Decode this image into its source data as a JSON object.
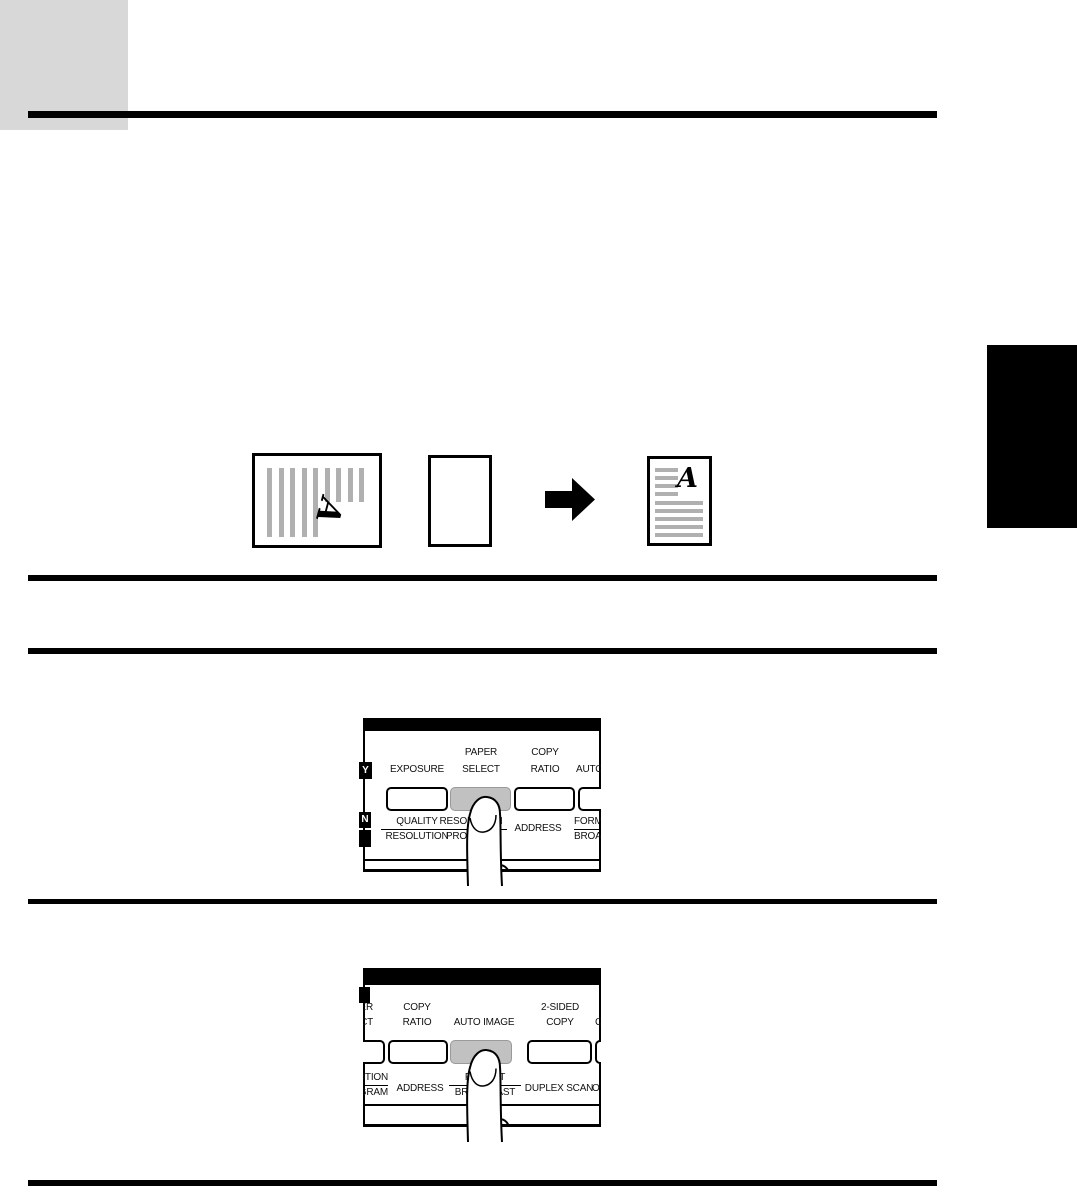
{
  "colors": {
    "page_bg": "#ffffff",
    "corner_block": "#d8d8d8",
    "side_index_tab": "#000000",
    "rules": "#000000",
    "panel_top_bar": "#000000",
    "key_face": "#ffffff",
    "pressed_key": "#c1c1c1",
    "thumbnail_stripes": "#b0b0b0"
  },
  "icons": {
    "arrow": "right-arrow-icon",
    "finger": "pointing-finger-icon"
  },
  "diagram": {
    "original_letter": "A",
    "output_letter": "A"
  },
  "panel1": {
    "side_tab_top": "Y",
    "side_tab_bottom": "N",
    "col1_line2": "EXPOSURE",
    "col2_line1": "PAPER",
    "col2_line2": "SELECT",
    "col3_line1": "COPY",
    "col3_line2": "RATIO",
    "col4_line2": "AUTO IMAGE",
    "bot1_top": "QUALITY",
    "bot1_bottom": "RESOLUTION",
    "bot2_top": "RESOLUTION",
    "bot2_bottom": "PROGRAM",
    "bot3": "ADDRESS",
    "bot4_top": "FORMAT",
    "bot4_bottom": "BROADCAST"
  },
  "panel2": {
    "edge_line1": "PAPER",
    "edge_line2": "SELECT",
    "col1_line1": "COPY",
    "col1_line2": "RATIO",
    "col2_line2": "AUTO IMAGE",
    "col3_line1": "2-SIDED",
    "col3_line2": "COPY",
    "col4_line2": "C",
    "bot1_top": "RESOLUTION",
    "bot1_bottom": "PROGRAM",
    "bot2": "ADDRESS",
    "bot3_top": "FORMAT",
    "bot3_bottom": "BROADCAST",
    "bot4": "DUPLEX SCAN",
    "bot5": "O"
  }
}
